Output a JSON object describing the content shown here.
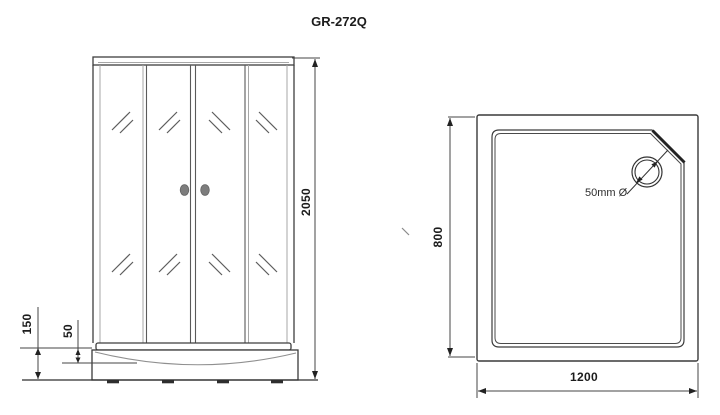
{
  "title": "GR-272Q",
  "front_view": {
    "dim_total_height": "2050",
    "dim_tray_height": "150",
    "dim_tray_inner_depth": "50"
  },
  "top_view": {
    "dim_depth": "800",
    "dim_width": "1200",
    "drain_label": "50mm Ø"
  },
  "colors": {
    "line": "#3f3f3f",
    "light_line": "#a7a7a7",
    "handle_fill": "#7d7d7d",
    "text": "#1c1c1c",
    "background": "#ffffff"
  }
}
